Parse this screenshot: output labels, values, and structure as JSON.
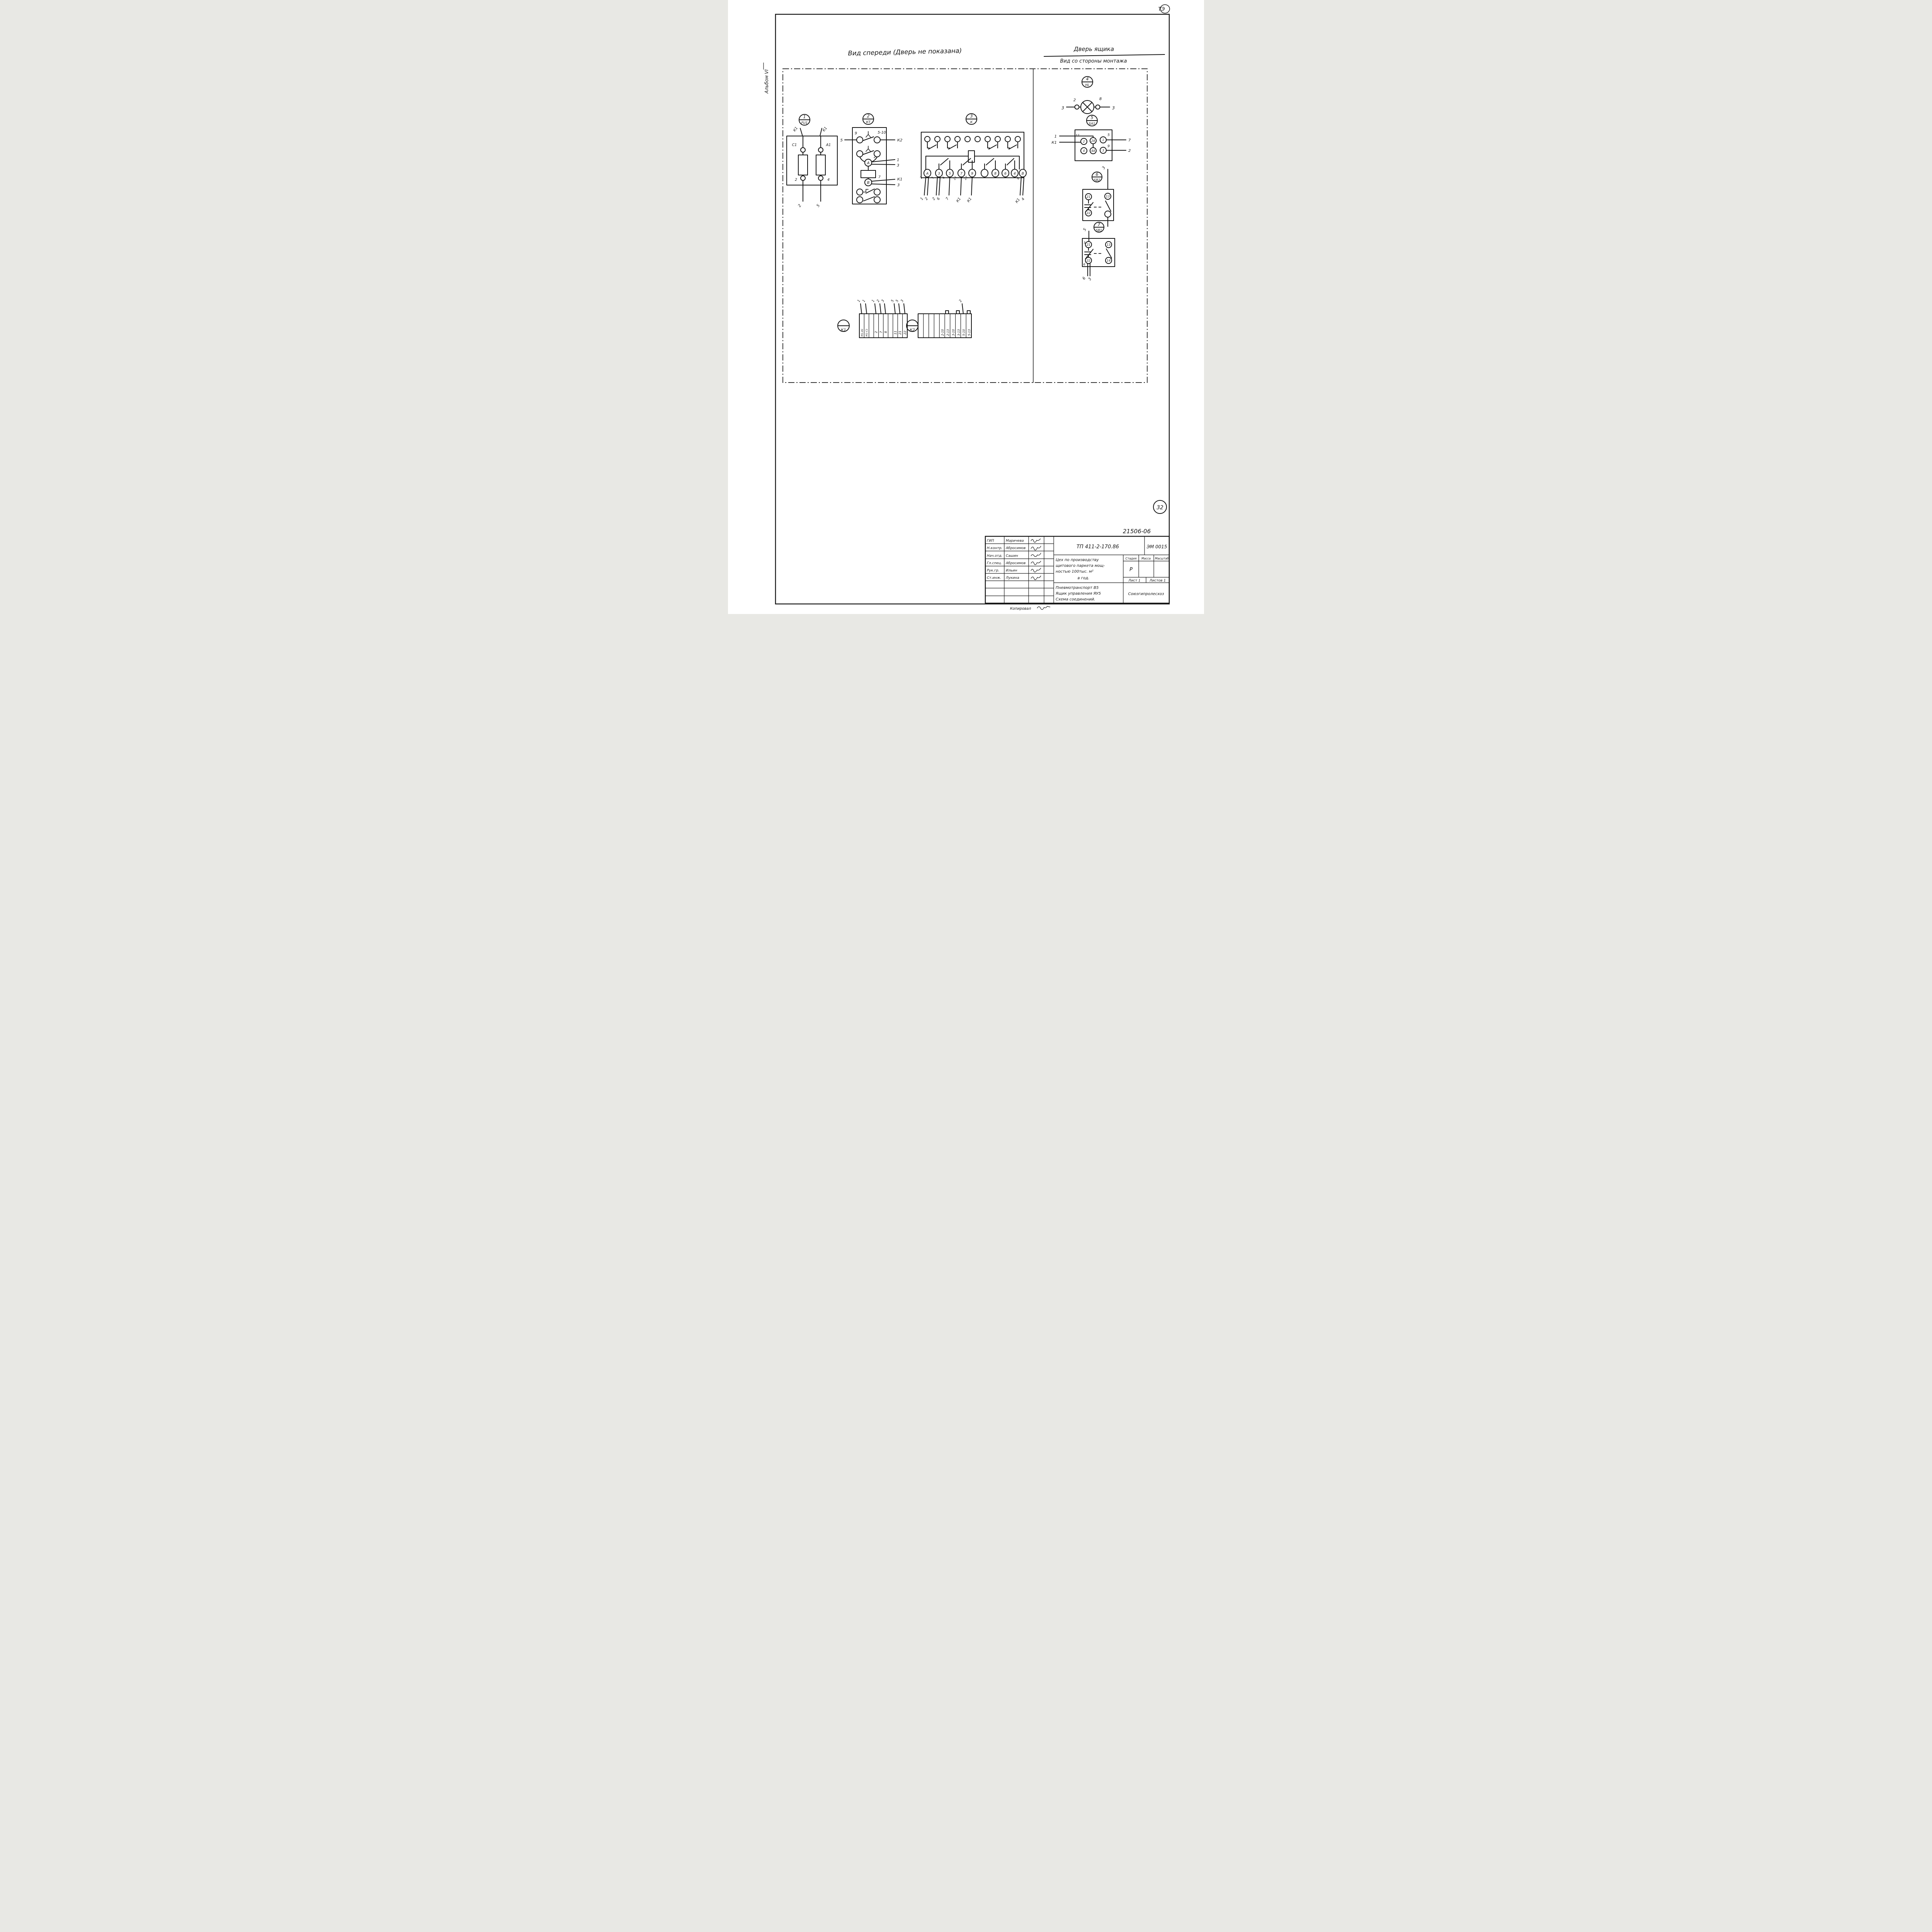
{
  "colors": {
    "ink": "#161616",
    "paper": "#ffffff"
  },
  "page": {
    "corner_mark": "ТЭ",
    "album_label": "Альбом VI",
    "front_view_title": "Вид спереди (Дверь не показана)",
    "door_view_title": "Дверь ящика",
    "door_view_subtitle": "Вид со стороны монтажа",
    "page_number": "32",
    "doc_number": "21506-06",
    "copied_label": "Копировал"
  },
  "fu1": {
    "id_num": "1",
    "id_tag": "FU1",
    "wire_top_left": "К1",
    "wire_top_right": "К1",
    "term_top_left": "С1",
    "term_top_right": "А1",
    "term_bottom_left": "2",
    "term_bottom_right": "4",
    "wire_bottom_left": "2",
    "wire_bottom_right": "5"
  },
  "kt": {
    "id_num": "2",
    "id_tag": "КТ",
    "contact_left_num": "9",
    "contact_right_num": "5-10",
    "wire_left": "5",
    "wire_right": "К2",
    "coil_a": "А",
    "coil_b": "В",
    "a_wire_num": "2",
    "a_dest_top": "1",
    "a_dest_bottom": "3",
    "b_wire_num": "7",
    "b_dest_top": "К1",
    "b_dest_bottom": "3"
  },
  "k": {
    "id_num": "3",
    "id_tag": "К",
    "bottom_terms": [
      "А",
      "3",
      "5",
      "7",
      "9",
      "",
      "8",
      "6",
      "4",
      "В"
    ],
    "term_wire_nums": [
      "2",
      "1",
      "6",
      "21",
      "22",
      "8"
    ],
    "drops": {
      "a": [
        "1",
        "2"
      ],
      "t3": [
        "2",
        "6"
      ],
      "t5": [
        "7"
      ],
      "t7": [
        "К1"
      ],
      "t9": [
        "К1"
      ],
      "b": [
        "К1",
        "4"
      ]
    }
  },
  "hl": {
    "id_num": "4",
    "id_tag": "HL",
    "term_left": "2",
    "term_right": "8",
    "wire_left": "3",
    "wire_right": "3"
  },
  "sa1": {
    "id_num": "5",
    "id_tag": "SA1",
    "t2": "2",
    "t2a": "2А",
    "t1": "1",
    "t4": "4",
    "t4a": "4А",
    "t3": "3",
    "n11": "11",
    "n5": "5",
    "n9": "9",
    "wire_in_top": "1",
    "wire_in_left": "К1",
    "wire_out_top": "7",
    "wire_out_bottom": "2"
  },
  "sb2": {
    "id_num": "6",
    "id_tag": "SB2",
    "t21": "21",
    "t13": "13",
    "t22": "22",
    "wire_top": "3"
  },
  "sb1": {
    "id_num": "7",
    "id_tag": "SB1",
    "t21": "21",
    "t13": "13",
    "t22": "22",
    "t14": "14",
    "wire_top": "5",
    "inner_top": "5",
    "inner_bottom": "6",
    "wire_bottom_left": "6",
    "wire_bottom_right": "3"
  },
  "block_k1": {
    "tag": "К1",
    "cells": [
      "М1-А1",
      "М1-С1",
      "",
      "2",
      "7",
      "8",
      "",
      "11",
      "21",
      "22"
    ],
    "wires": [
      "1",
      "1",
      "",
      "1",
      "2",
      "3",
      "",
      "5",
      "5",
      "3"
    ]
  },
  "block_k2": {
    "tag": "К2",
    "cells": [
      "",
      "",
      "",
      "",
      "2-10",
      "2-13",
      "3-10",
      "3-13",
      "5-10",
      "5-13"
    ],
    "wire_label": "2"
  },
  "title_block": {
    "tp_number": "ТП 411-2-170.86",
    "code": "ЭМ 0015",
    "people": [
      {
        "role": "ГИП",
        "name": "Маричева"
      },
      {
        "role": "Н.контр.",
        "name": "Абросимов"
      },
      {
        "role": "Нач.отд.",
        "name": "Сашин"
      },
      {
        "role": "Гл.спец.",
        "name": "Абросимов"
      },
      {
        "role": "Рук.гр.",
        "name": "Ильин"
      },
      {
        "role": "Ст.инж.",
        "name": "Лукина"
      }
    ],
    "project_lines": [
      "Цех по производству",
      "щитового паркета мощ-",
      "ностью 100тыс. м²",
      "в год."
    ],
    "stage_header": "Стадия",
    "mass_header": "Масса",
    "scale_header": "Масштаб",
    "stage_value": "Р",
    "sheet_label": "Лист 1",
    "sheets_label": "Листов 1",
    "subject_lines": [
      "Пневмотранспорт В5",
      "Ящик управления ЯУ5",
      "Схема соединений."
    ],
    "org": "Союзгипролесхоз"
  }
}
